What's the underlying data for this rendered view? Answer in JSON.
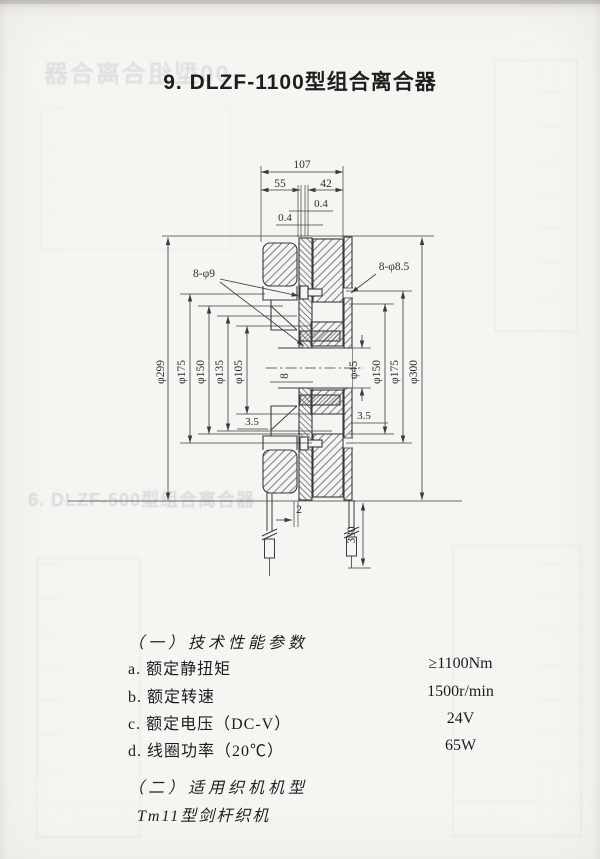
{
  "page": {
    "title": "9. DLZF-1100型组合离合器"
  },
  "drawing": {
    "dim_overall_width": "107",
    "dim_left_width": "55",
    "dim_right_width": "42",
    "dim_gap_a": "0.4",
    "dim_gap_b": "0.4",
    "holes_left": "8-φ9",
    "holes_right": "8-φ8.5",
    "left_diameters": [
      "φ299",
      "φ175",
      "φ150",
      "φ135",
      "φ105"
    ],
    "right_diameters": [
      "φ45",
      "φ150",
      "φ175",
      "φ300"
    ],
    "keyway_width": "8",
    "step_left": "3.5",
    "step_right": "3.5",
    "dim_gap_bottom": "2",
    "dim_lead_length": "330"
  },
  "specs": {
    "section1_title": "（一）技术性能参数",
    "items": [
      {
        "label": "a. 额定静扭矩",
        "value": "≥1100Nm"
      },
      {
        "label": "b. 额定转速",
        "value": "1500r/min"
      },
      {
        "label": "c. 额定电压（DC-V）",
        "value": "24V"
      },
      {
        "label": "d. 线圈功率（20℃）",
        "value": "65W"
      }
    ],
    "section2_title": "（二）适用织机机型",
    "machine_type": "Tm11型剑杆织机"
  },
  "ghosts": {
    "top_left": "00型组合离合器",
    "mid_left": "6. DLZF-500型组合离合器"
  },
  "colors": {
    "ink": "#3a3a3a",
    "paper": "#f6f5f1",
    "ghost": "#bcc3cf"
  }
}
